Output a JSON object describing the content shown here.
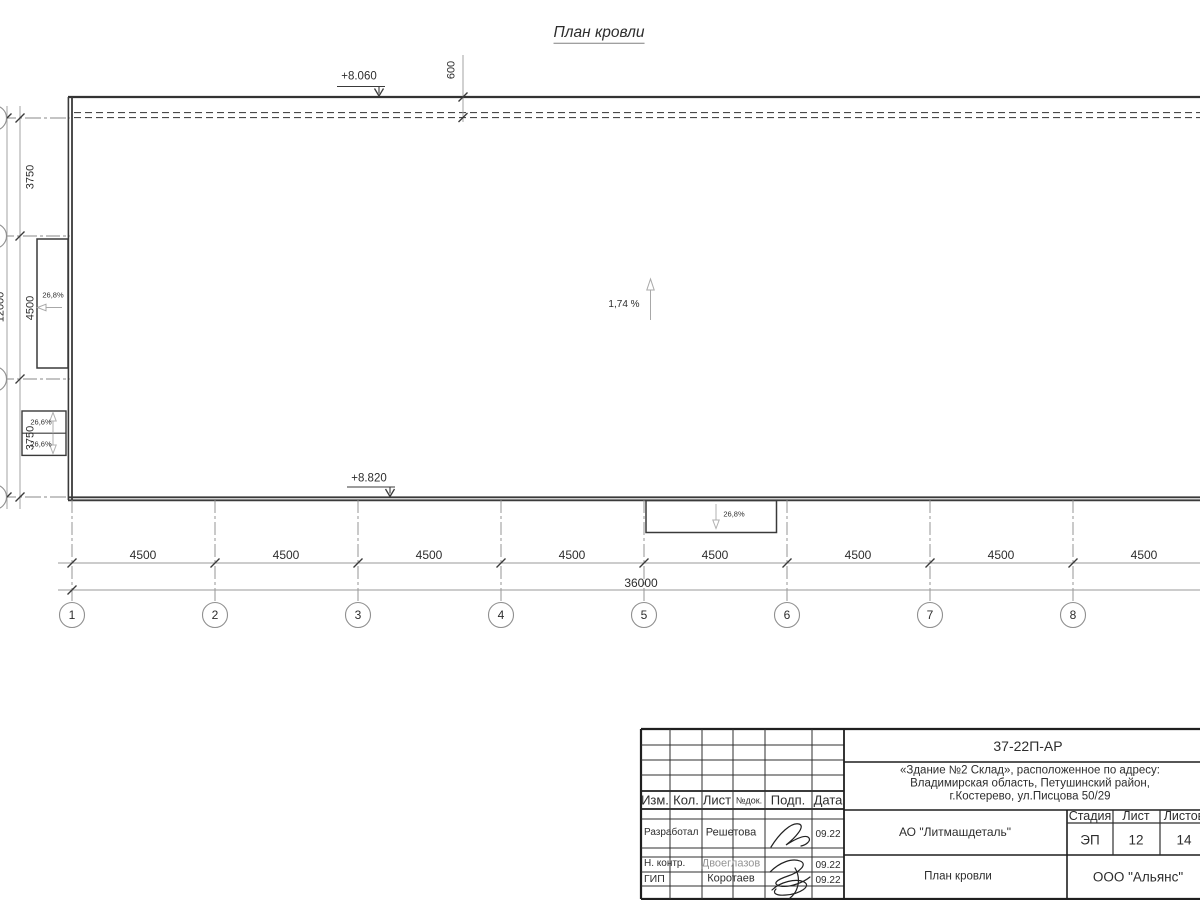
{
  "drawing": {
    "title": "План кровли",
    "elevation_top": "+8.060",
    "elevation_bottom": "+8.820",
    "parapet_offset": "600",
    "slope_main": "1,74 %",
    "slope_left_big": "26,8%",
    "slope_left_small_1": "26,6%",
    "slope_left_small_2": "26,6%",
    "slope_canopy": "26,8%"
  },
  "dimensions": {
    "left": [
      "3750",
      "4500",
      "3750"
    ],
    "left_total": "12000",
    "bottom": [
      "4500",
      "4500",
      "4500",
      "4500",
      "4500",
      "4500",
      "4500",
      "4500"
    ],
    "bottom_total": "36000"
  },
  "axes": [
    "1",
    "2",
    "3",
    "4",
    "5",
    "6",
    "7",
    "8"
  ],
  "titleblock": {
    "doc_number": "37-22П-АР",
    "address_line1": "«Здание №2 Склад», расположенное по адресу:",
    "address_line2": "Владимирская область, Петушинский район,",
    "address_line3": "г.Костерево, ул.Писцова 50/29",
    "header": {
      "izm": "Изм.",
      "kol": "Кол.",
      "list": "Лист",
      "ndok": "№док.",
      "podp": "Подп.",
      "data": "Дата"
    },
    "rows": [
      {
        "role": "Разработал",
        "name": "Решетова",
        "date": "09.22"
      },
      {
        "role": "Н. контр.",
        "name": "Двоеглазов",
        "date": "09.22"
      },
      {
        "role": "ГИП",
        "name": "Коротаев",
        "date": "09.22"
      }
    ],
    "company": "АО \"Литмашдеталь\"",
    "stage_label": "Стадия",
    "sheet_label": "Лист",
    "sheets_label": "Листов",
    "stage": "ЭП",
    "sheet": "12",
    "sheets": "14",
    "sheet_title": "План кровли",
    "org": "ООО \"Альянс\""
  },
  "colors": {
    "line_dark": "#3a3a3a",
    "line_dim": "#999999",
    "text": "#2d2d2d"
  }
}
